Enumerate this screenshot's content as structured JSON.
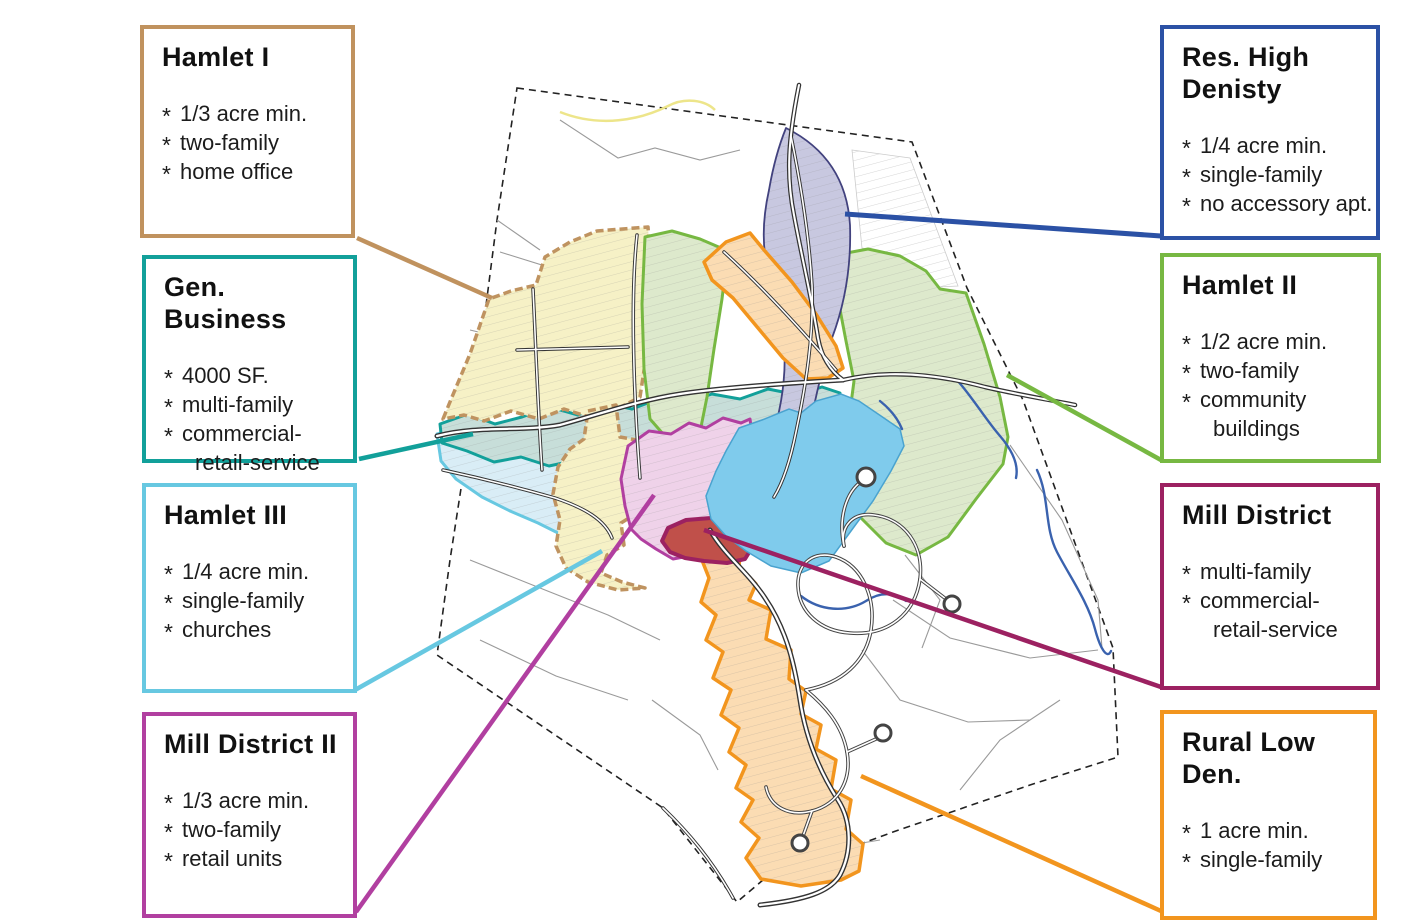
{
  "bullet_char": "*",
  "callouts": [
    {
      "id": "hamlet-1",
      "title": "Hamlet I",
      "color": "#C0925E",
      "items": [
        {
          "text": "1/3 acre min.",
          "cont": false
        },
        {
          "text": "two-family",
          "cont": false
        },
        {
          "text": "home office",
          "cont": false
        }
      ]
    },
    {
      "id": "gen-business",
      "title": "Gen. Business",
      "color": "#12A09A",
      "items": [
        {
          "text": "4000 SF.",
          "cont": false
        },
        {
          "text": "multi-family",
          "cont": false
        },
        {
          "text": "commercial-",
          "cont": false
        },
        {
          "text": "retail-service",
          "cont": true
        }
      ]
    },
    {
      "id": "hamlet-3",
      "title": "Hamlet III",
      "color": "#67C8E1",
      "items": [
        {
          "text": "1/4 acre min.",
          "cont": false
        },
        {
          "text": "single-family",
          "cont": false
        },
        {
          "text": "churches",
          "cont": false
        }
      ]
    },
    {
      "id": "mill-district-2",
      "title": "Mill District II",
      "color": "#B13FA0",
      "items": [
        {
          "text": "1/3 acre min.",
          "cont": false
        },
        {
          "text": "two-family",
          "cont": false
        },
        {
          "text": "retail units",
          "cont": false
        }
      ]
    },
    {
      "id": "res-high-density",
      "title": "Res. High\nDenisty",
      "color": "#2B51A5",
      "items": [
        {
          "text": "1/4 acre min.",
          "cont": false
        },
        {
          "text": "single-family",
          "cont": false
        },
        {
          "text": "no accessory apt.",
          "cont": false
        }
      ]
    },
    {
      "id": "hamlet-2",
      "title": "Hamlet II",
      "color": "#77B842",
      "items": [
        {
          "text": "1/2 acre min.",
          "cont": false
        },
        {
          "text": "two-family",
          "cont": false
        },
        {
          "text": "community",
          "cont": false
        },
        {
          "text": "buildings",
          "cont": true
        }
      ]
    },
    {
      "id": "mill-district",
      "title": "Mill District",
      "color": "#9C2161",
      "items": [
        {
          "text": "multi-family",
          "cont": false
        },
        {
          "text": "commercial-",
          "cont": false
        },
        {
          "text": "retail-service",
          "cont": true
        }
      ]
    },
    {
      "id": "rural-low-density",
      "title": "Rural Low Den.",
      "color": "#F2951E",
      "items": [
        {
          "text": "1 acre min.",
          "cont": false
        },
        {
          "text": "single-family",
          "cont": false
        }
      ]
    }
  ],
  "map": {
    "boundary": "M517,88 L912,142 L967,288 L1023,400 L1113,648 L1118,757 L1030,785 L893,832 L763,880 L737,902 L663,808 L437,655 L450,560 L470,430 L497,220 Z",
    "yellow_route": {
      "d": "M560,112 C600,128 640,120 668,106 C685,97 705,100 715,110",
      "color": "#EDE58A",
      "w": 2.5
    },
    "field_lines": [
      {
        "d": "M500,252 L558,270 L602,256 L645,262"
      },
      {
        "d": "M560,120 L618,158 L655,148 L700,160 L740,150"
      },
      {
        "d": "M940,300 L990,360 L1008,440"
      },
      {
        "d": "M1010,445 L1062,520 L1098,600 L1102,648"
      },
      {
        "d": "M893,600 L950,638 L1030,658 L1098,650"
      },
      {
        "d": "M862,650 L900,700 L968,722 L1030,720"
      },
      {
        "d": "M470,560 L540,588 L608,615 L660,640"
      },
      {
        "d": "M480,640 L556,676 L628,700"
      },
      {
        "d": "M652,700 L700,735 L718,770"
      },
      {
        "d": "M960,790 L1000,740 L1060,700"
      },
      {
        "d": "M760,880 L820,850 L880,840"
      },
      {
        "d": "M497,220 L540,250"
      },
      {
        "d": "M470,330 L520,342"
      },
      {
        "d": "M838,440 L900,452 L1003,464",
        "dash": "2 3"
      },
      {
        "d": "M905,555 L940,600 L922,648"
      }
    ],
    "white_hatch": "M852,150 L910,158 L958,286 L938,287 L922,268 L898,254 L862,248 Z",
    "zones": [
      {
        "name": "zone-hamlet-iii",
        "fill": "#D9EDF6",
        "stroke": "#67C8E1",
        "width": 3,
        "hatch": true,
        "d": "M437,434 L465,427 L492,438 L520,431 L548,443 L575,452 L600,462 L618,478 L622,500 L612,526 L596,546 L568,538 L538,523 L510,511 L482,497 L456,479 L441,461 Z"
      },
      {
        "name": "zone-gen-business",
        "fill": "#C7DED9",
        "stroke": "#12A09A",
        "width": 3,
        "hatch": true,
        "d": "M440,424 L468,414 L495,424 L522,417 L550,407 L578,415 L605,403 L632,409 L658,399 L685,403 L712,394 L740,399 L768,389 L798,395 L822,387 L840,393 L842,420 L818,428 L792,438 L766,445 L738,452 L710,459 L684,465 L656,469 L630,462 L604,469 L577,460 L549,466 L521,457 L494,462 L467,451 L442,443 Z"
      },
      {
        "name": "zone-hamlet-i-north",
        "fill": "#F6F1C6",
        "stroke": "#BF9360",
        "width": 3.5,
        "dashed": true,
        "hatch": true,
        "d": "M443,419 L452,397 L470,354 L489,299 L511,291 L536,285 L545,257 L570,242 L597,231 L648,227 L652,289 L648,344 L640,397 L619,408 L592,418 L564,409 L539,419 L511,411 L484,421 L464,415 Z"
      },
      {
        "name": "zone-hamlet-i-south",
        "fill": "#F6F1C6",
        "stroke": "#BF9360",
        "width": 3.5,
        "dashed": true,
        "hatch": true,
        "d": "M588,411 L616,405 L620,437 L642,441 L656,451 L648,477 L634,494 L637,513 L621,523 L624,545 L607,555 L601,573 L622,582 L645,588 L618,590 L588,582 L566,568 L556,546 L560,520 L553,494 L558,467 L570,449 L584,439 Z"
      },
      {
        "name": "zone-hamlet-ii-strip",
        "fill": "#DDE9CC",
        "stroke": "#77B842",
        "width": 3,
        "hatch": true,
        "d": "M645,237 L672,231 L700,239 L728,251 L722,299 L714,349 L707,397 L700,432 L684,442 L664,435 L650,419 L644,369 L642,304 Z"
      },
      {
        "name": "zone-hamlet-ii-east",
        "fill": "#DDE9CC",
        "stroke": "#77B842",
        "width": 3,
        "hatch": true,
        "d": "M836,255 L868,249 L900,256 L926,271 L940,289 L966,293 L984,344 L1000,397 L1008,437 L1003,464 L976,499 L948,537 L916,555 L886,543 L860,517 L845,489 L838,457 L849,419 L854,381 L846,341 L838,299 Z"
      },
      {
        "name": "zone-res-high-density",
        "fill": "#C8C8E0",
        "stroke": "#42427E",
        "width": 1.8,
        "hatch": true,
        "d": "M786,128 Q846,158 850,225 Q852,285 832,338 Q818,382 811,422 Q804,462 789,496 Q777,510 770,492 Q767,460 777,420 Q787,380 784,340 Q779,300 768,270 Q759,235 769,190 Q775,155 786,128 Z"
      },
      {
        "name": "zone-rural-low-density-north",
        "fill": "#FBDCB3",
        "stroke": "#F2951E",
        "width": 3.5,
        "hatch": true,
        "d": "M704,262 L726,242 L750,233 L764,250 L792,282 L816,314 L836,346 L843,368 L828,378 L806,379 L783,358 L758,328 L733,298 L712,280 Z"
      },
      {
        "name": "zone-rural-low-density-south",
        "fill": "#FBDCB3",
        "stroke": "#F2951E",
        "width": 3.5,
        "hatch": true,
        "d": "M694,540 L722,531 L741,544 L739,566 L756,584 L749,600 L771,610 L766,639 L791,650 L789,679 L806,691 L801,714 L821,725 L816,749 L836,760 L831,789 L851,800 L846,829 L863,844 L859,871 L841,880 L801,886 L761,879 L746,858 L759,838 L741,822 L753,800 L736,788 L746,765 L729,752 L739,728 L721,715 L731,690 L713,678 L723,652 L706,640 L716,615 L701,602 L709,578 Z"
      },
      {
        "name": "zone-mill-district-ii",
        "fill": "#EFD2E9",
        "stroke": "#B13FA0",
        "width": 3,
        "hatch": true,
        "d": "M628,446 L649,431 L671,434 L689,423 L706,428 L723,418 L741,423 L750,419 L753,441 L741,466 L726,491 L713,516 L701,541 L689,556 L673,559 L656,549 L641,539 L631,529 L625,506 L621,479 Z"
      },
      {
        "name": "zone-mill-district",
        "fill": "#C0504A",
        "stroke": "#9C2161",
        "width": 4,
        "hatch": false,
        "d": "M662,541 L668,528 L686,520 L711,518 L731,523 L749,529 L753,546 L745,559 L727,563 L704,561 L685,558 L670,552 Z"
      }
    ],
    "lake": {
      "name": "lake",
      "fill": "#7FCBEC",
      "stroke": "#4AA3CF",
      "width": 1.5,
      "d": "M739,428 L762,420 L789,409 L801,413 L816,401 L841,394 L859,401 L881,416 L900,429 L904,446 L891,471 L873,501 L851,531 L829,561 L801,573 L771,566 L746,551 L726,536 L711,519 L706,496 L716,471 L726,451 Z"
    },
    "rivers": [
      {
        "name": "river-northeast",
        "d": "M957,380 C973,398 986,420 1000,436 C1012,450 1019,464 1016,478"
      },
      {
        "name": "river-east",
        "d": "M1037,470 C1050,498 1044,527 1057,552 C1070,577 1088,602 1095,629 C1100,648 1107,660 1111,651"
      },
      {
        "name": "stream-below-lake",
        "d": "M801,596 C820,611 846,613 866,601 C881,591 896,593 906,601"
      },
      {
        "name": "stream-lake-inlet",
        "d": "M880,401 C890,409 898,419 902,429"
      }
    ],
    "roads": [
      {
        "name": "road-north",
        "w": 4.5,
        "d": "M799,85 C788,140 786,175 794,215 C802,258 812,300 818,338 C822,360 832,372 843,380"
      },
      {
        "name": "road-main-street",
        "w": 5,
        "d": "M437,436 C480,425 520,432 560,425 C600,414 640,400 680,394 C720,388 790,383 843,380"
      },
      {
        "name": "road-east",
        "w": 4.5,
        "d": "M843,380 C890,369 940,375 985,387 C1015,394 1045,399 1075,405"
      },
      {
        "name": "road-res-high-corridor",
        "w": 3.5,
        "d": "M791,136 C801,185 809,235 812,285 C814,335 806,385 796,432 C790,462 782,484 774,497"
      },
      {
        "name": "road-rural-north-corridor",
        "w": 3.5,
        "d": "M724,252 C760,285 795,322 836,370"
      },
      {
        "name": "road-south",
        "w": 5,
        "d": "M710,530 C725,556 748,572 765,598 C788,632 795,668 800,700 C806,740 820,772 838,800 C852,822 852,852 840,875 C830,892 805,900 760,905"
      },
      {
        "name": "road-southwest",
        "w": 3.5,
        "d": "M663,808 C688,832 712,860 733,898"
      },
      {
        "name": "road-village-1",
        "w": 3.5,
        "d": "M533,289 C536,350 538,410 542,470"
      },
      {
        "name": "road-village-2",
        "w": 3.5,
        "d": "M637,235 C630,300 634,400 640,478"
      },
      {
        "name": "road-village-3",
        "w": 3.5,
        "d": "M517,350 L628,347"
      },
      {
        "name": "road-village-4",
        "w": 3.5,
        "d": "M443,470 C480,478 520,488 555,498 C585,508 605,520 612,538"
      }
    ],
    "subdivision_roads": [
      {
        "name": "subdivision-loop-main",
        "d": "M806,690 C842,683 866,662 871,630 C876,597 862,566 836,557 C814,550 797,563 798,586 C799,612 820,631 850,633 C888,636 915,614 920,579 C924,546 905,519 874,515 C853,512 840,526 844,546"
      },
      {
        "name": "subdivision-loop-upper",
        "d": "M844,546 C838,518 846,492 862,481"
      },
      {
        "name": "subdivision-loop-south",
        "d": "M806,690 C824,705 842,724 847,752 C852,781 838,804 812,811 C789,817 770,807 766,787"
      },
      {
        "name": "subdivision-stem-a",
        "d": "M847,752 L876,739"
      },
      {
        "name": "subdivision-stem-b",
        "d": "M920,579 L946,599"
      },
      {
        "name": "subdivision-stem-c",
        "d": "M812,811 L803,836"
      }
    ],
    "culdesacs": [
      {
        "cx": 866,
        "cy": 477,
        "r": 9
      },
      {
        "cx": 883,
        "cy": 733,
        "r": 8
      },
      {
        "cx": 952,
        "cy": 604,
        "r": 8
      },
      {
        "cx": 800,
        "cy": 843,
        "r": 8
      }
    ],
    "leaders": [
      {
        "name": "leader-hamlet-1",
        "x1": 357,
        "y1": 238,
        "x2": 492,
        "y2": 298,
        "c": "#C0925E",
        "w": 4.5
      },
      {
        "name": "leader-gen-business",
        "x1": 359,
        "y1": 459,
        "x2": 473,
        "y2": 434,
        "c": "#12A09A",
        "w": 4.5
      },
      {
        "name": "leader-hamlet-3",
        "x1": 355,
        "y1": 690,
        "x2": 602,
        "y2": 551,
        "c": "#67C8E1",
        "w": 4.5
      },
      {
        "name": "leader-mill-district-2",
        "x1": 356,
        "y1": 912,
        "x2": 654,
        "y2": 495,
        "c": "#B13FA0",
        "w": 4.5
      },
      {
        "name": "leader-res-high-density",
        "x1": 845,
        "y1": 214,
        "x2": 1161,
        "y2": 236,
        "c": "#2B51A5",
        "w": 5
      },
      {
        "name": "leader-hamlet-2",
        "x1": 1007,
        "y1": 375,
        "x2": 1161,
        "y2": 460,
        "c": "#77B842",
        "w": 4.5
      },
      {
        "name": "leader-mill-district",
        "x1": 704,
        "y1": 530,
        "x2": 1161,
        "y2": 687,
        "c": "#9C2161",
        "w": 4.5
      },
      {
        "name": "leader-rural-low-density",
        "x1": 861,
        "y1": 776,
        "x2": 1161,
        "y2": 911,
        "c": "#F2951E",
        "w": 4.5
      }
    ]
  }
}
